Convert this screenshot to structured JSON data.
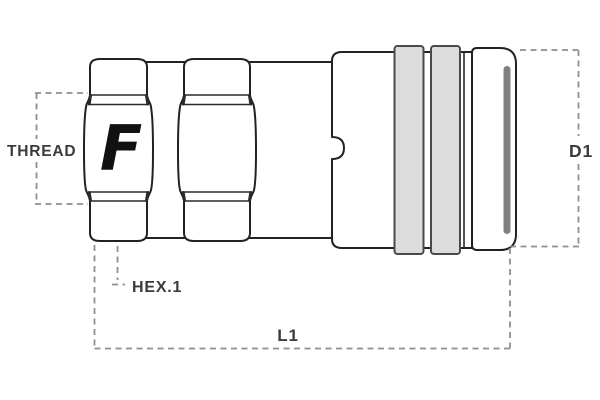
{
  "diagram": {
    "labels": {
      "thread": "THREAD",
      "hex1": "HEX.1",
      "length": "L1",
      "diameter": "D1"
    },
    "logo": {
      "name": "faster-logo",
      "letter": "F"
    },
    "colors": {
      "background": "#ffffff",
      "outline": "#222222",
      "dimension_line": "#8f8f8f",
      "label_text": "#3b3b3b",
      "grip_band_fill": "#dcdcdc",
      "grip_band_edge": "#4a4a4a",
      "end_cap_shade": "#808080"
    }
  }
}
